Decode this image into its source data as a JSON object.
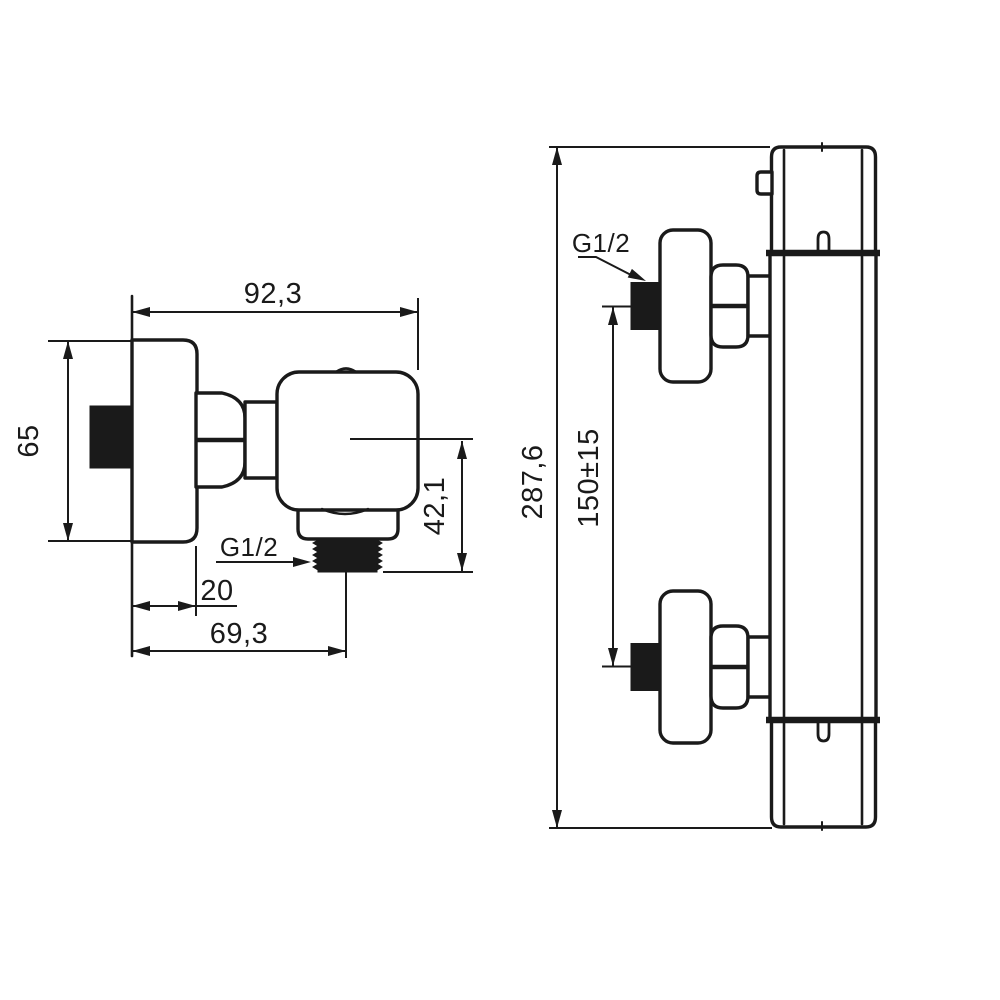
{
  "drawing": {
    "background": "#ffffff",
    "line_color": "#1a1a1a",
    "views": {
      "side": {
        "name": "side-view",
        "dim_width": "92,3",
        "dim_height": "65",
        "dim_outlet_drop": "42,1",
        "dim_wall_depth": "20",
        "dim_outlet_offset": "69,3",
        "thread_label": "G1/2"
      },
      "front": {
        "name": "front-view",
        "dim_height_total": "287,6",
        "dim_connection_spacing": "150±15",
        "thread_label": "G1/2"
      }
    }
  }
}
